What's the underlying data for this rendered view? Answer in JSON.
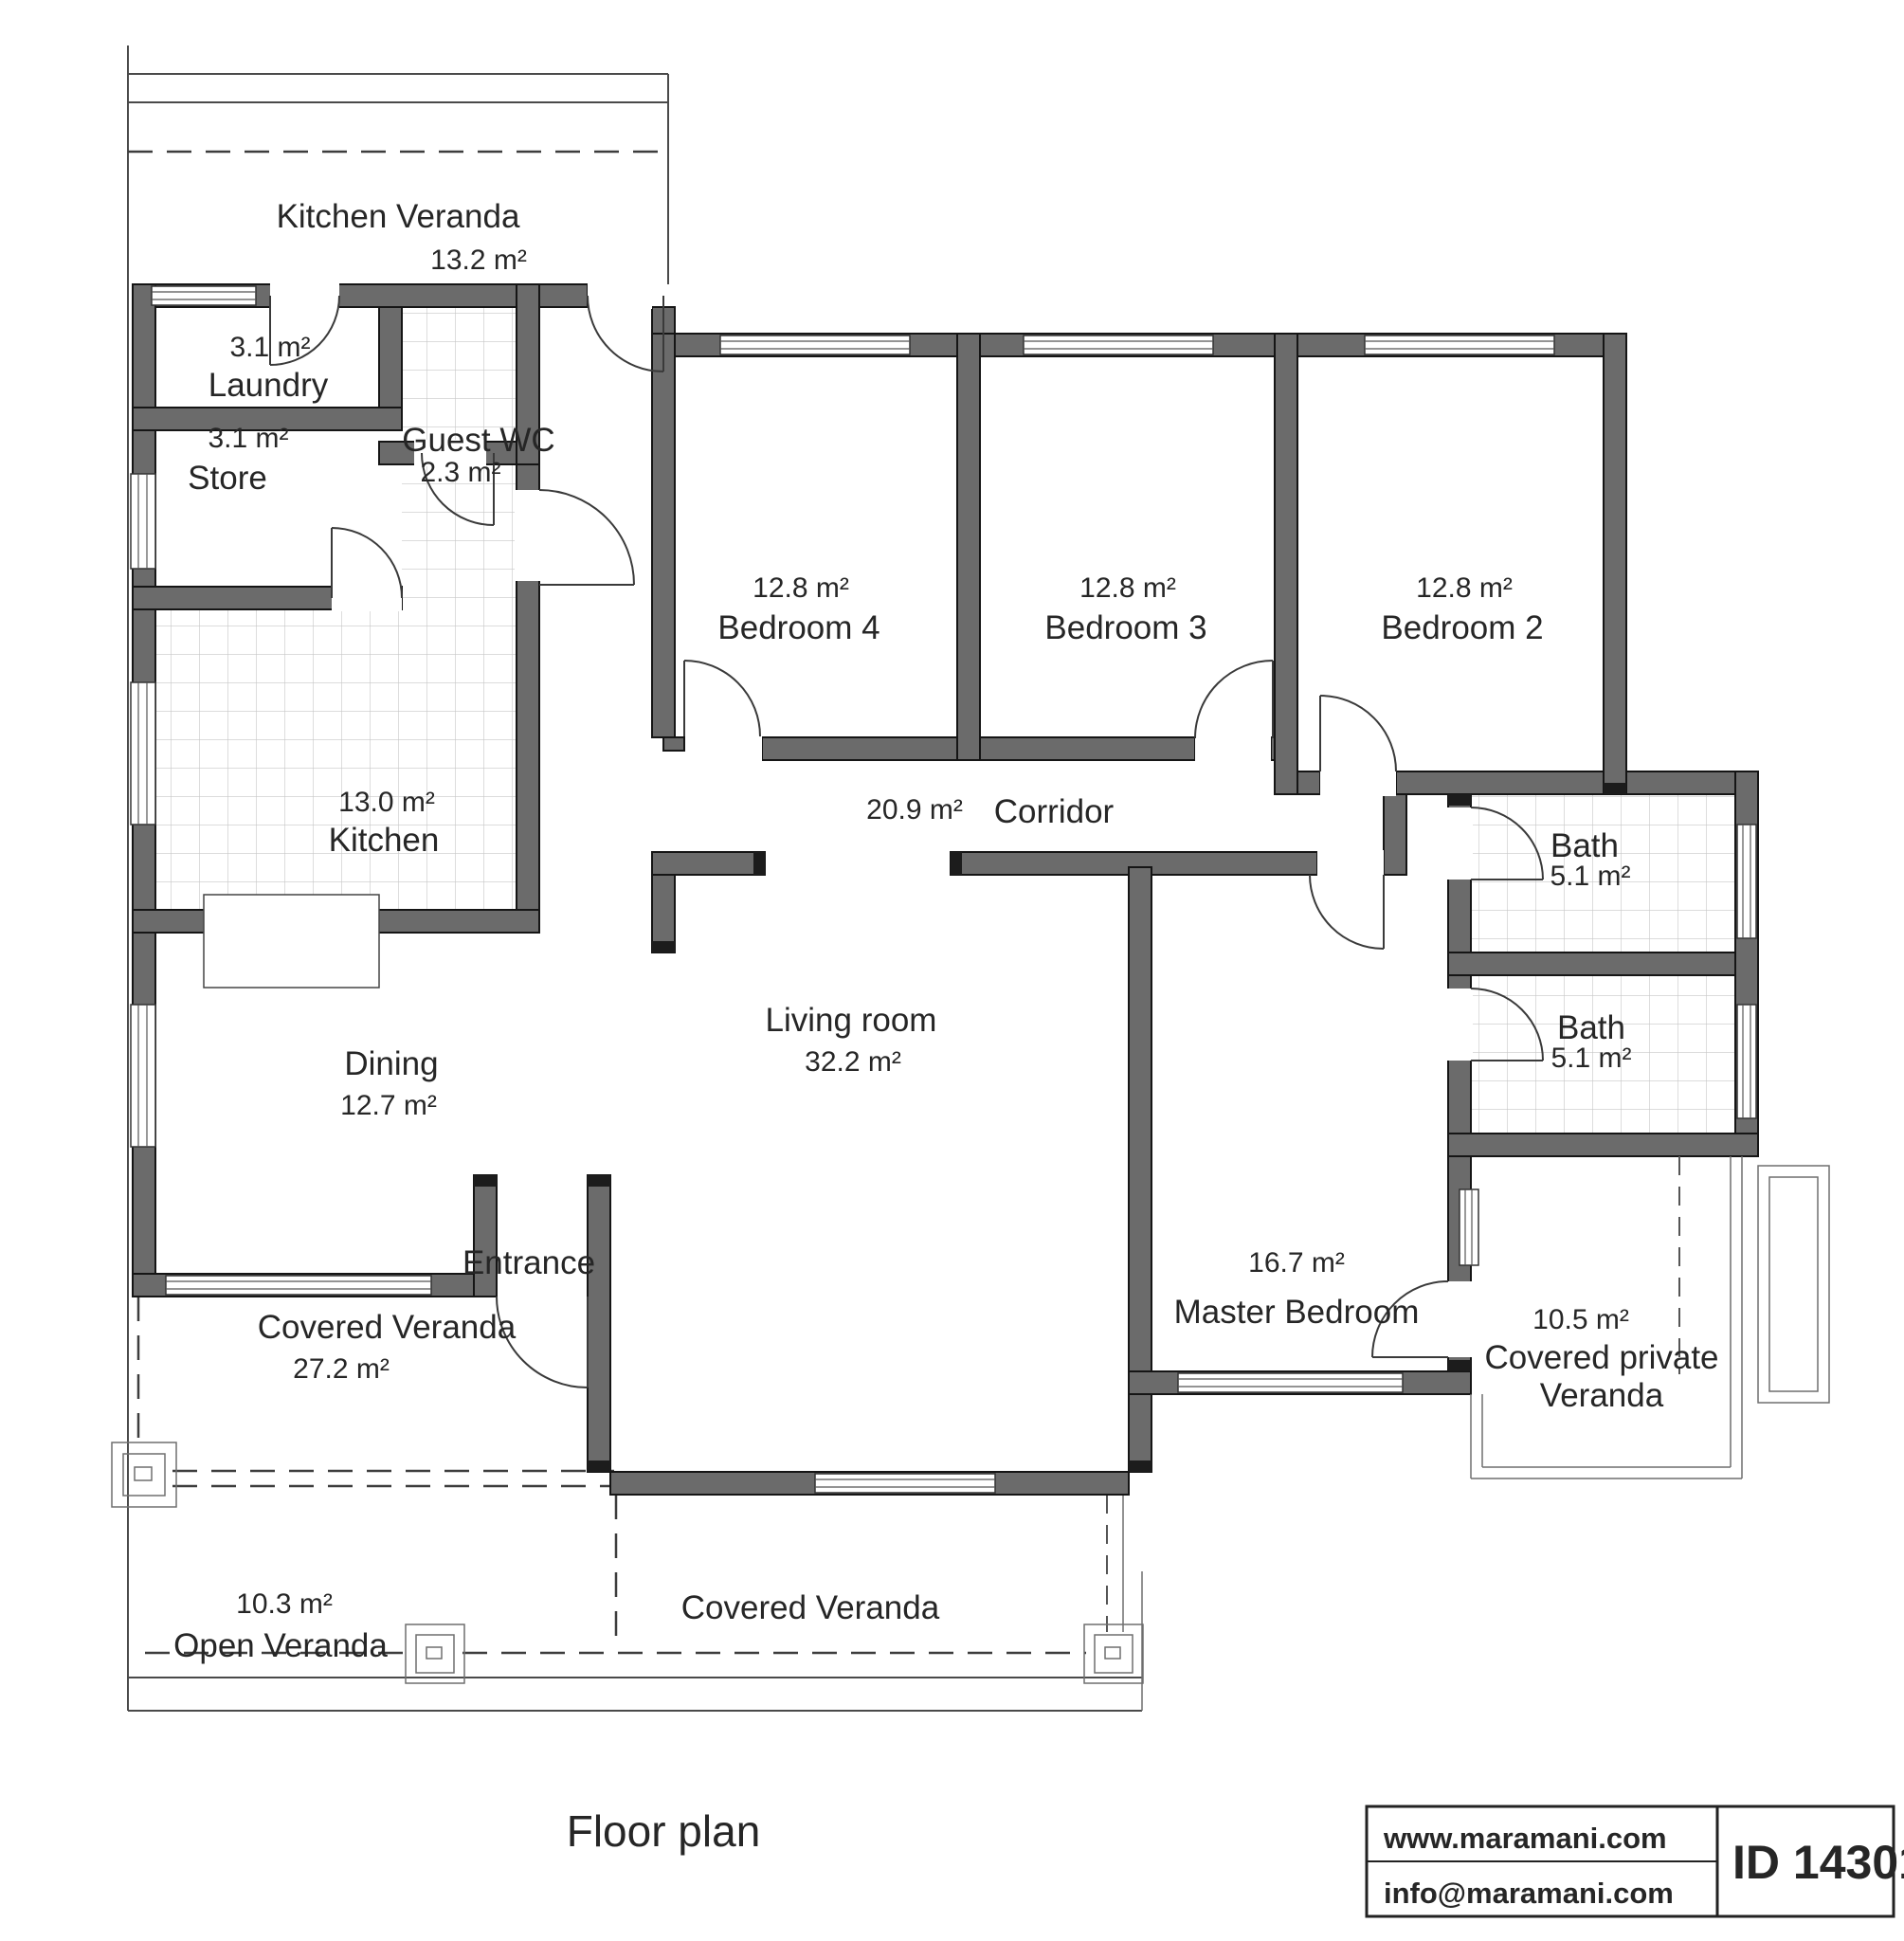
{
  "title": "Floor plan",
  "rooms": {
    "kitchen_veranda": {
      "name": "Kitchen Veranda",
      "area": "13.2 m²"
    },
    "laundry": {
      "name": "Laundry",
      "area": "3.1 m²"
    },
    "store": {
      "name": "Store",
      "area": "3.1 m²"
    },
    "guest_wc": {
      "name": "Guest WC",
      "area": "2.3 m²"
    },
    "kitchen": {
      "name": "Kitchen",
      "area": "13.0 m²"
    },
    "bedroom4": {
      "name": "Bedroom 4",
      "area": "12.8 m²"
    },
    "bedroom3": {
      "name": "Bedroom 3",
      "area": "12.8 m²"
    },
    "bedroom2": {
      "name": "Bedroom 2",
      "area": "12.8 m²"
    },
    "corridor": {
      "name": "Corridor",
      "area": "20.9 m²"
    },
    "bath1": {
      "name": "Bath",
      "area": "5.1 m²"
    },
    "bath2": {
      "name": "Bath",
      "area": "5.1 m²"
    },
    "dining": {
      "name": "Dining",
      "area": "12.7 m²"
    },
    "living": {
      "name": "Living room",
      "area": "32.2 m²"
    },
    "master": {
      "name": "Master Bedroom",
      "area": "16.7 m²"
    },
    "private_veranda": {
      "name_line1": "Covered private",
      "name_line2": "Veranda",
      "area": "10.5 m²"
    },
    "covered_veranda_left": {
      "name": "Covered Veranda",
      "area": "27.2 m²"
    },
    "covered_veranda_bottom": {
      "name": "Covered Veranda"
    },
    "open_veranda": {
      "name": "Open Veranda",
      "area": "10.3 m²"
    },
    "entrance": {
      "name": "Entrance"
    }
  },
  "footer": {
    "website": "www.maramani.com",
    "email": "info@maramani.com",
    "plan_id": "ID 14301"
  },
  "colors": {
    "wall_fill": "#6b6b6b",
    "wall_stroke": "#151515",
    "line": "#4a4a4a",
    "tile_line": "#c6c6c6",
    "text": "#262626",
    "dash": "#3d3d3d"
  }
}
